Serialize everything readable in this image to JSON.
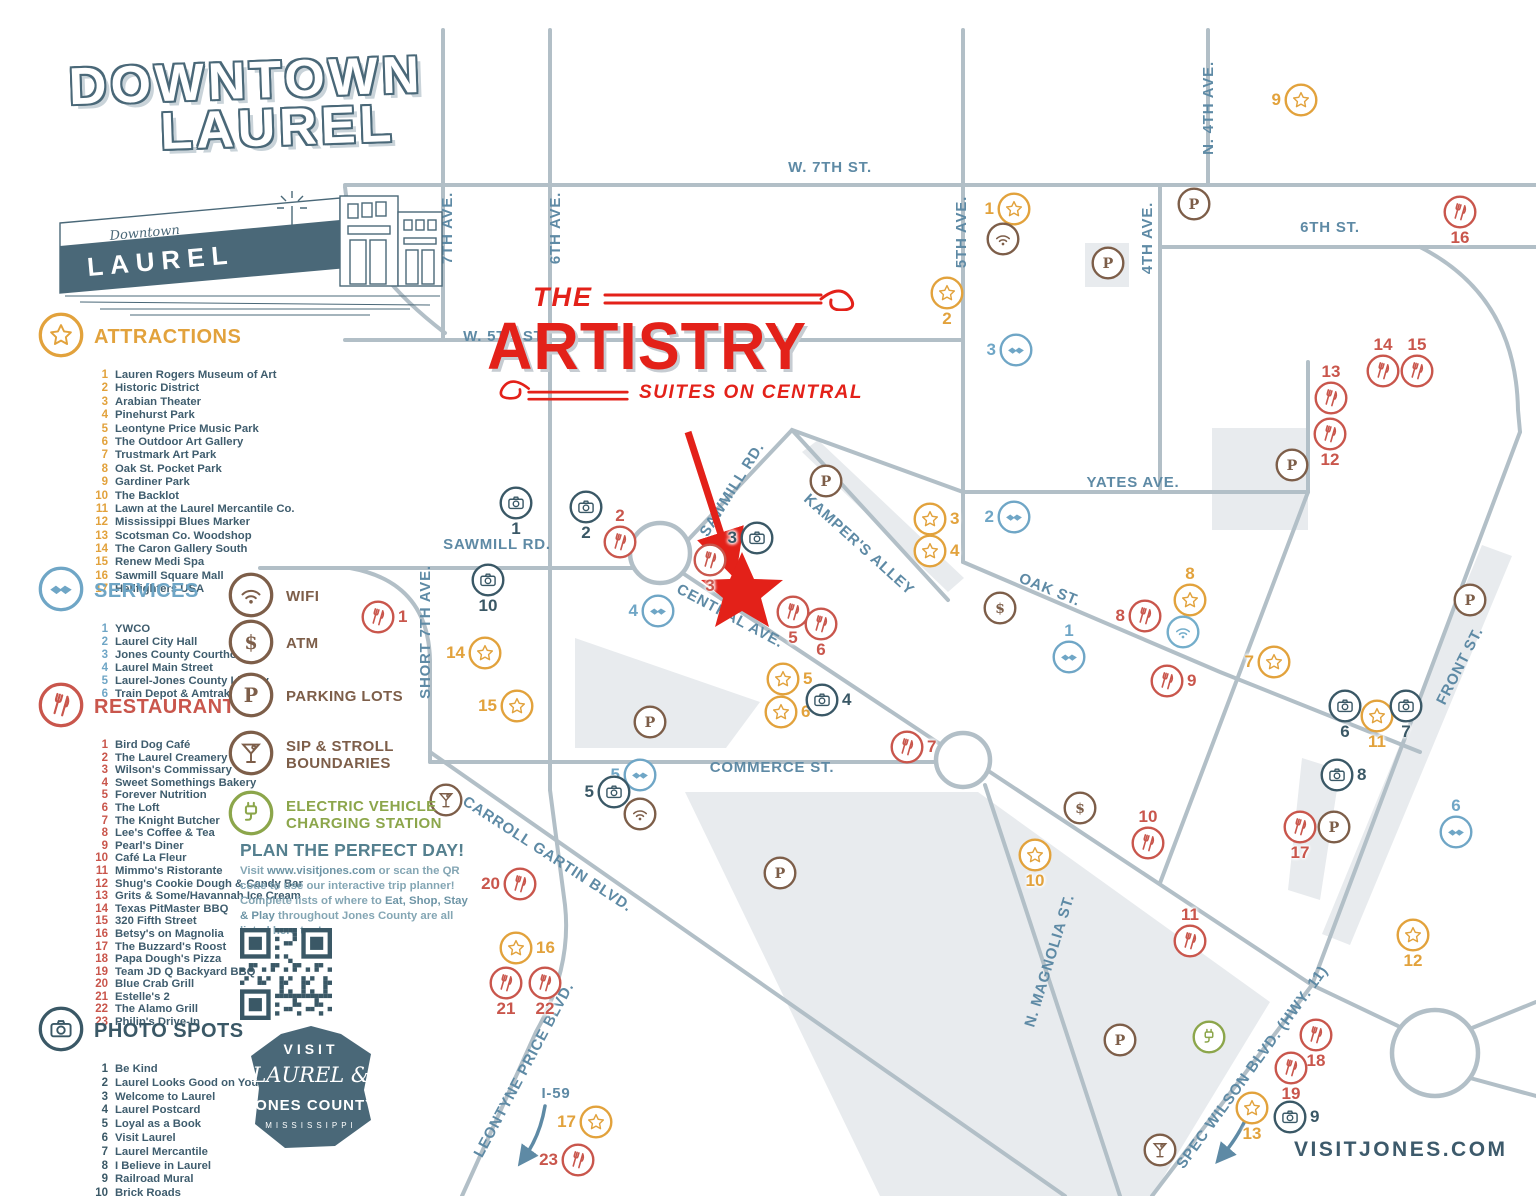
{
  "title": {
    "line1": "DOWNTOWN",
    "line2": "LAUREL"
  },
  "branding": {
    "artistry": {
      "the": "THE",
      "name": "ARTISTRY",
      "tagline": "SUITES ON CENTRAL"
    },
    "building": {
      "script": "Downtown",
      "sign": "LAUREL"
    },
    "visit_badge": {
      "line1": "VISIT",
      "line2": "LAUREL &",
      "line3": "JONES COUNTY",
      "line4": "MISSISSIPPI"
    },
    "website": "VISITJONES.COM"
  },
  "colors": {
    "attraction": "#E2A23C",
    "service": "#6FA6C6",
    "restaurant": "#C9564C",
    "photo": "#3A5866",
    "brown": "#7D5E49",
    "green": "#8CA64B",
    "wifi_blue": "#74AECB",
    "street": "#B2BFC7",
    "street_label": "#5E8AA5",
    "accent_red": "#E32119",
    "slate": "#4A6878",
    "block": "#E8EBEE"
  },
  "legend": {
    "attractions": {
      "label": "ATTRACTIONS",
      "items": [
        "Lauren Rogers Museum of Art",
        "Historic District",
        "Arabian Theater",
        "Pinehurst Park",
        "Leontyne Price Music Park",
        "The Outdoor Art Gallery",
        "Trustmark Art Park",
        "Oak St. Pocket Park",
        "Gardiner Park",
        "The Backlot",
        "Lawn at the Laurel Mercantile Co.",
        "Mississippi Blues Marker",
        "Scotsman Co. Woodshop",
        "The Caron Gallery South",
        "Renew Medi Spa",
        "Sawmill Square Mall",
        "Hellfighters USA"
      ]
    },
    "services": {
      "label": "SERVICES",
      "items": [
        "YWCO",
        "Laurel City Hall",
        "Jones County Courthouse",
        "Laurel Main Street",
        "Laurel-Jones County Library",
        "Train Depot & Amtrak"
      ]
    },
    "restaurants": {
      "label": "RESTAURANTS",
      "items": [
        "Bird Dog Café",
        "The Laurel Creamery",
        "Wilson's Commissary",
        "Sweet Somethings Bakery",
        "Forever Nutrition",
        "The Loft",
        "The Knight Butcher",
        "Lee's Coffee & Tea",
        "Pearl's Diner",
        "Café La Fleur",
        "Mimmo's Ristorante",
        "Shug's Cookie Dough & Candy Bar",
        "Grits & Some/Havannah Ice Cream",
        "Texas PitMaster BBQ",
        "320 Fifth Street",
        "Betsy's on Magnolia",
        "The Buzzard's Roost",
        "Papa Dough's Pizza",
        "Team JD Q Backyard BBQ",
        "Blue Crab Grill",
        "Estelle's 2",
        "The Alamo Grill",
        "Philip's Drive-In"
      ]
    },
    "photo_spots": {
      "label": "PHOTO SPOTS",
      "items": [
        "Be Kind",
        "Laurel Looks Good on You",
        "Welcome to Laurel",
        "Laurel Postcard",
        "Loyal as a Book",
        "Visit Laurel",
        "Laurel Mercantile",
        "I Believe in Laurel",
        "Railroad Mural",
        "Brick Roads"
      ]
    }
  },
  "amenities": [
    {
      "icon": "wifi",
      "label": "WIFI",
      "color": "brown"
    },
    {
      "icon": "atm",
      "label": "ATM",
      "color": "brown"
    },
    {
      "icon": "parking",
      "label": "PARKING LOTS",
      "color": "brown"
    },
    {
      "icon": "martini",
      "label": "SIP & STROLL BOUNDARIES",
      "color": "brown"
    },
    {
      "icon": "ev",
      "label": "ELECTRIC VEHICLE CHARGING STATION",
      "color": "green"
    }
  ],
  "plan": {
    "heading": "PLAN THE PERFECT DAY!",
    "p1": "Visit ",
    "b1": "www.visitjones.com",
    "p2": " or scan the QR code to use our interactive trip planner! Complete lists of where to ",
    "b2": "Eat, Shop, Stay & Play",
    "p3": " throughout Jones County are all listed here too!"
  },
  "map": {
    "street_labels": [
      {
        "text": "W. 7TH ST.",
        "x": 830,
        "y": 172,
        "r": 0
      },
      {
        "text": "7TH AVE.",
        "x": 452,
        "y": 228,
        "r": -90
      },
      {
        "text": "6TH AVE.",
        "x": 560,
        "y": 228,
        "r": -90
      },
      {
        "text": "5TH AVE.",
        "x": 966,
        "y": 232,
        "r": -90
      },
      {
        "text": "N. 4TH AVE.",
        "x": 1213,
        "y": 108,
        "r": -90
      },
      {
        "text": "4TH AVE.",
        "x": 1152,
        "y": 238,
        "r": -90
      },
      {
        "text": "6TH ST.",
        "x": 1330,
        "y": 232,
        "r": 0
      },
      {
        "text": "W. 5TH ST.",
        "x": 505,
        "y": 341,
        "r": 0
      },
      {
        "text": "SAWMILL RD.",
        "x": 497,
        "y": 549,
        "r": 0
      },
      {
        "text": "SAWMILL RD.",
        "x": 736,
        "y": 492,
        "r": -58
      },
      {
        "text": "SHORT 7TH AVE.",
        "x": 430,
        "y": 632,
        "r": -90
      },
      {
        "text": "KAMPER'S ALLEY",
        "x": 856,
        "y": 548,
        "r": 42
      },
      {
        "text": "YATES AVE.",
        "x": 1133,
        "y": 487,
        "r": 0
      },
      {
        "text": "OAK ST.",
        "x": 1048,
        "y": 594,
        "r": 22
      },
      {
        "text": "CENTRAL AVE.",
        "x": 728,
        "y": 620,
        "r": 28
      },
      {
        "text": "COMMERCE ST.",
        "x": 772,
        "y": 772,
        "r": 0
      },
      {
        "text": "CARROLL GARTIN BLVD.",
        "x": 545,
        "y": 858,
        "r": 33
      },
      {
        "text": "LEONTYNE PRICE BLVD.",
        "x": 528,
        "y": 1072,
        "r": -62
      },
      {
        "text": "N. MAGNOLIA ST.",
        "x": 1054,
        "y": 962,
        "r": -73
      },
      {
        "text": "SPEC WILSON BLVD. (HWY. 11)",
        "x": 1256,
        "y": 1070,
        "r": -54,
        "fs": 14
      },
      {
        "text": "FRONT ST.",
        "x": 1464,
        "y": 668,
        "r": -63
      },
      {
        "text": "I-59",
        "x": 556,
        "y": 1098,
        "r": 0,
        "fs": 23
      }
    ],
    "markers": [
      {
        "cat": "a",
        "n": 9,
        "x": 1301,
        "y": 100,
        "np": "l"
      },
      {
        "cat": "a",
        "n": 1,
        "x": 1014,
        "y": 209,
        "np": "l"
      },
      {
        "cat": "a",
        "n": 2,
        "x": 947,
        "y": 293,
        "np": "b"
      },
      {
        "cat": "a",
        "n": 3,
        "x": 930,
        "y": 519,
        "np": "r"
      },
      {
        "cat": "a",
        "n": 4,
        "x": 930,
        "y": 551,
        "np": "r"
      },
      {
        "cat": "a",
        "n": 8,
        "x": 1190,
        "y": 600,
        "np": "a"
      },
      {
        "cat": "a",
        "n": 7,
        "x": 1274,
        "y": 662,
        "np": "l"
      },
      {
        "cat": "a",
        "n": 11,
        "x": 1377,
        "y": 716,
        "np": "b"
      },
      {
        "cat": "a",
        "n": 5,
        "x": 783,
        "y": 679,
        "np": "r"
      },
      {
        "cat": "a",
        "n": 6,
        "x": 781,
        "y": 712,
        "np": "r"
      },
      {
        "cat": "a",
        "n": 14,
        "x": 485,
        "y": 653,
        "np": "l"
      },
      {
        "cat": "a",
        "n": 15,
        "x": 517,
        "y": 706,
        "np": "l"
      },
      {
        "cat": "a",
        "n": 16,
        "x": 516,
        "y": 948,
        "np": "r"
      },
      {
        "cat": "a",
        "n": 10,
        "x": 1035,
        "y": 855,
        "np": "b"
      },
      {
        "cat": "a",
        "n": 17,
        "x": 596,
        "y": 1122,
        "np": "l"
      },
      {
        "cat": "a",
        "n": 13,
        "x": 1252,
        "y": 1108,
        "np": "b"
      },
      {
        "cat": "a",
        "n": 12,
        "x": 1413,
        "y": 935,
        "np": "b"
      },
      {
        "cat": "s",
        "n": 3,
        "x": 1016,
        "y": 350,
        "np": "l"
      },
      {
        "cat": "s",
        "n": 2,
        "x": 1014,
        "y": 517,
        "np": "l"
      },
      {
        "cat": "s",
        "n": 1,
        "x": 1069,
        "y": 657,
        "np": "a"
      },
      {
        "cat": "s",
        "n": 4,
        "x": 658,
        "y": 611,
        "np": "l"
      },
      {
        "cat": "s",
        "n": 5,
        "x": 640,
        "y": 775,
        "np": "l"
      },
      {
        "cat": "s",
        "n": 6,
        "x": 1456,
        "y": 832,
        "np": "a"
      },
      {
        "cat": "r",
        "n": 16,
        "x": 1460,
        "y": 212,
        "np": "b"
      },
      {
        "cat": "r",
        "n": 2,
        "x": 620,
        "y": 542,
        "np": "a"
      },
      {
        "cat": "r",
        "n": 3,
        "x": 710,
        "y": 560,
        "np": "b"
      },
      {
        "cat": "r",
        "n": 5,
        "x": 793,
        "y": 612,
        "np": "b"
      },
      {
        "cat": "r",
        "n": 6,
        "x": 821,
        "y": 624,
        "np": "b"
      },
      {
        "cat": "r",
        "n": 1,
        "x": 378,
        "y": 617,
        "np": "r"
      },
      {
        "cat": "r",
        "n": 14,
        "x": 1383,
        "y": 371,
        "np": "a"
      },
      {
        "cat": "r",
        "n": 15,
        "x": 1417,
        "y": 371,
        "np": "a"
      },
      {
        "cat": "r",
        "n": 13,
        "x": 1331,
        "y": 398,
        "np": "a"
      },
      {
        "cat": "r",
        "n": 12,
        "x": 1330,
        "y": 434,
        "np": "b"
      },
      {
        "cat": "r",
        "n": 8,
        "x": 1145,
        "y": 616,
        "np": "l"
      },
      {
        "cat": "r",
        "n": 9,
        "x": 1167,
        "y": 681,
        "np": "r"
      },
      {
        "cat": "r",
        "n": 10,
        "x": 1148,
        "y": 843,
        "np": "a"
      },
      {
        "cat": "r",
        "n": 11,
        "x": 1190,
        "y": 941,
        "np": "a"
      },
      {
        "cat": "r",
        "n": 17,
        "x": 1300,
        "y": 827,
        "np": "b"
      },
      {
        "cat": "r",
        "n": 7,
        "x": 907,
        "y": 747,
        "np": "r"
      },
      {
        "cat": "r",
        "n": 20,
        "x": 520,
        "y": 884,
        "np": "l"
      },
      {
        "cat": "r",
        "n": 21,
        "x": 506,
        "y": 983,
        "np": "b"
      },
      {
        "cat": "r",
        "n": 22,
        "x": 545,
        "y": 983,
        "np": "b"
      },
      {
        "cat": "r",
        "n": 18,
        "x": 1316,
        "y": 1035,
        "np": "b"
      },
      {
        "cat": "r",
        "n": 19,
        "x": 1291,
        "y": 1068,
        "np": "b"
      },
      {
        "cat": "r",
        "n": 23,
        "x": 578,
        "y": 1160,
        "np": "l"
      },
      {
        "cat": "p",
        "n": 1,
        "x": 516,
        "y": 503,
        "np": "b"
      },
      {
        "cat": "p",
        "n": 2,
        "x": 586,
        "y": 507,
        "np": "b"
      },
      {
        "cat": "p",
        "n": 10,
        "x": 488,
        "y": 580,
        "np": "b"
      },
      {
        "cat": "p",
        "n": 3,
        "x": 757,
        "y": 538,
        "np": "l"
      },
      {
        "cat": "p",
        "n": 4,
        "x": 822,
        "y": 700,
        "np": "r"
      },
      {
        "cat": "p",
        "n": 5,
        "x": 614,
        "y": 792,
        "np": "l"
      },
      {
        "cat": "p",
        "n": 6,
        "x": 1345,
        "y": 706,
        "np": "b"
      },
      {
        "cat": "p",
        "n": 7,
        "x": 1406,
        "y": 706,
        "np": "b"
      },
      {
        "cat": "p",
        "n": 8,
        "x": 1337,
        "y": 775,
        "np": "r"
      },
      {
        "cat": "p",
        "n": 9,
        "x": 1290,
        "y": 1117,
        "np": "r"
      }
    ],
    "icons": [
      {
        "icon": "wifi",
        "x": 1003,
        "y": 239,
        "color": "brown"
      },
      {
        "icon": "wifi",
        "x": 1183,
        "y": 632,
        "color": "wifi_blue"
      },
      {
        "icon": "wifi",
        "x": 640,
        "y": 814,
        "color": "brown"
      },
      {
        "icon": "atm",
        "x": 1000,
        "y": 608,
        "color": "brown"
      },
      {
        "icon": "atm",
        "x": 1080,
        "y": 808,
        "color": "brown"
      },
      {
        "icon": "parking",
        "x": 1194,
        "y": 204,
        "color": "brown"
      },
      {
        "icon": "parking",
        "x": 1108,
        "y": 263,
        "color": "brown"
      },
      {
        "icon": "parking",
        "x": 826,
        "y": 481,
        "color": "brown"
      },
      {
        "icon": "parking",
        "x": 1292,
        "y": 465,
        "color": "brown"
      },
      {
        "icon": "parking",
        "x": 650,
        "y": 722,
        "color": "brown"
      },
      {
        "icon": "parking",
        "x": 780,
        "y": 873,
        "color": "brown"
      },
      {
        "icon": "parking",
        "x": 1470,
        "y": 600,
        "color": "brown"
      },
      {
        "icon": "parking",
        "x": 1334,
        "y": 827,
        "color": "brown"
      },
      {
        "icon": "parking",
        "x": 1120,
        "y": 1040,
        "color": "brown"
      },
      {
        "icon": "martini",
        "x": 446,
        "y": 800,
        "color": "brown"
      },
      {
        "icon": "martini",
        "x": 1160,
        "y": 1150,
        "color": "brown"
      },
      {
        "icon": "ev",
        "x": 1209,
        "y": 1037,
        "color": "green"
      }
    ]
  }
}
